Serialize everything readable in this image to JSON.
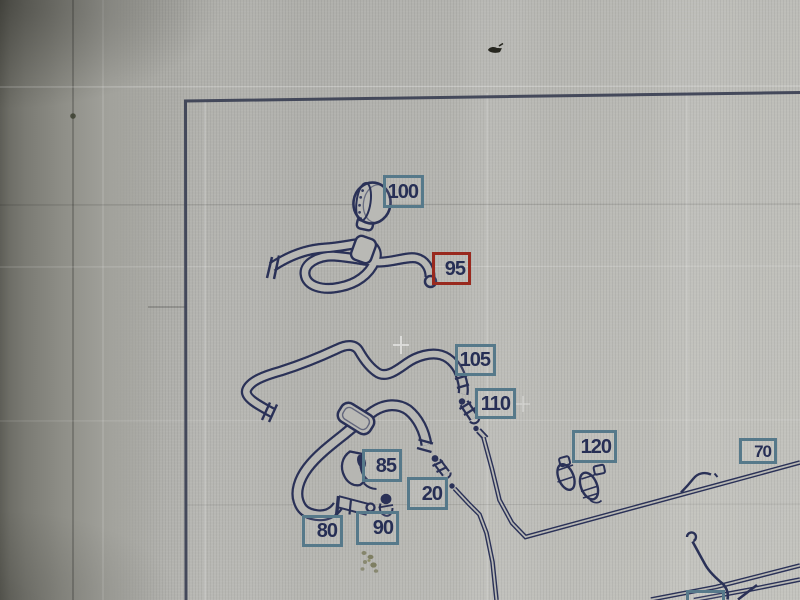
{
  "diagram": {
    "description": "vehicle hose and pipe parts diagram with numbered callouts",
    "callouts": [
      {
        "part": "100",
        "text": "100",
        "highlighted": false
      },
      {
        "part": "95",
        "text": "95",
        "highlighted": true
      },
      {
        "part": "105",
        "text": "105",
        "highlighted": false
      },
      {
        "part": "110",
        "text": "110",
        "highlighted": false
      },
      {
        "part": "85",
        "text": "85",
        "highlighted": false
      },
      {
        "part": "20",
        "text": "20",
        "highlighted": false
      },
      {
        "part": "80",
        "text": "80",
        "highlighted": false
      },
      {
        "part": "90",
        "text": "90",
        "highlighted": false
      },
      {
        "part": "120",
        "text": "120",
        "highlighted": false
      },
      {
        "part": "70",
        "text": "70",
        "highlighted": false
      }
    ],
    "highlighted_callout": "95"
  },
  "colors": {
    "screen_background": "#b3b3af",
    "callout_border": "#56798a",
    "highlight_border": "#99291e",
    "drawing_line": "#2a3157",
    "callout_text": "#272f55",
    "frame_border": "#3a3f52"
  }
}
